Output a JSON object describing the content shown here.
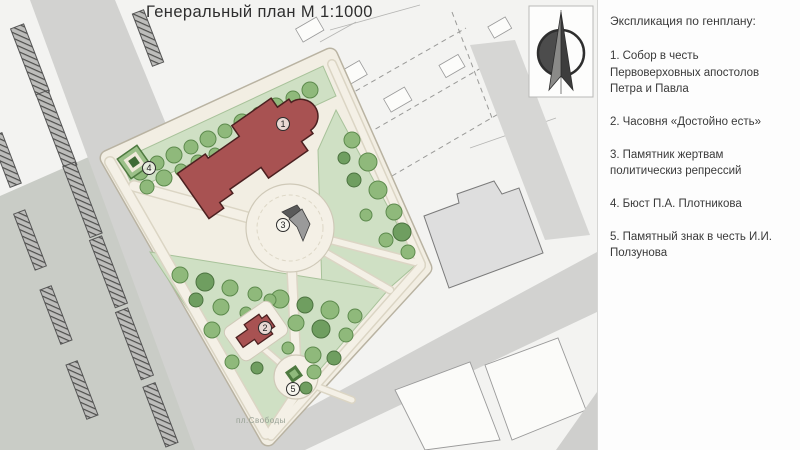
{
  "title": "Генеральный план М 1:1000",
  "legend": {
    "header": "Экспликация по генплану:",
    "items": [
      {
        "number": "1.",
        "text": "Собор в честь Первоверховных апостолов Петра и Павла"
      },
      {
        "number": "2.",
        "text": "Часовня «Достойно есть»"
      },
      {
        "number": "3.",
        "text": "Памятник жертвам политическиз репрессий"
      },
      {
        "number": "4.",
        "text": "Бюст П.А. Плотникова"
      },
      {
        "number": "5.",
        "text": "Памятный знак в честь И.И. Ползунова"
      }
    ]
  },
  "plan": {
    "markers": [
      {
        "number": "1"
      },
      {
        "number": "2"
      },
      {
        "number": "3"
      },
      {
        "number": "4"
      },
      {
        "number": "5"
      }
    ],
    "map_label": "пл.Свободы"
  },
  "icons": {
    "compass": "north-arrow"
  },
  "colors": {
    "building_red": "#a85252",
    "lawn_green": "#cfe0c4",
    "tree_green": "#8fb97b",
    "path_cream": "#f4f0e6",
    "road_gray": "#d2d2d0",
    "panel_white": "#fdfdfd"
  }
}
